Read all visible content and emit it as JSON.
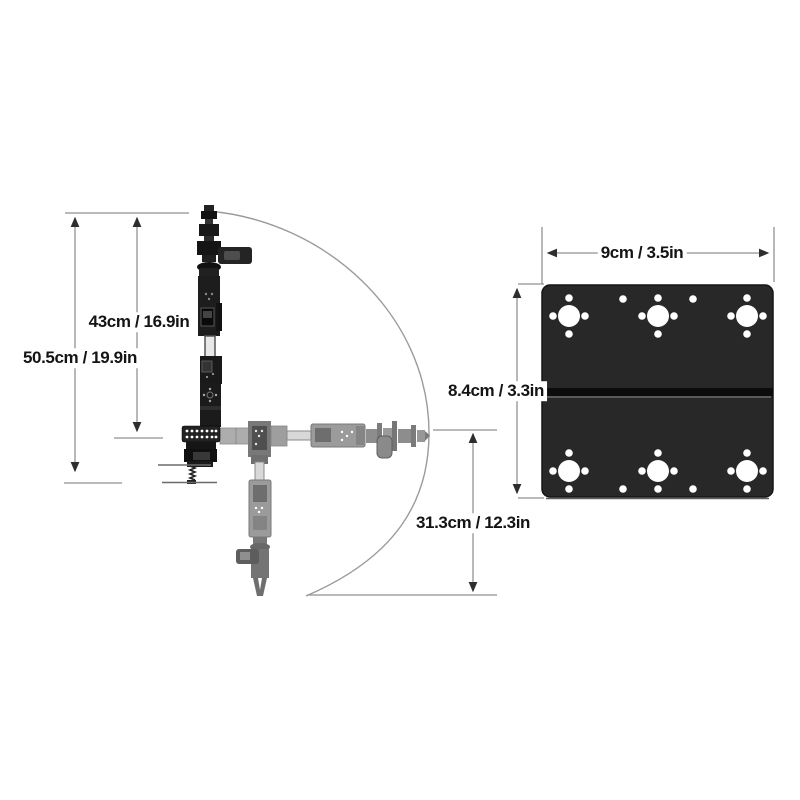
{
  "labels": {
    "overall_height": "50.5cm / 19.9in",
    "upper_height": "43cm / 16.9in",
    "lower_reach": "31.3cm / 12.3in",
    "plate_width": "9cm / 3.5in",
    "plate_height": "8.4cm / 3.3in"
  },
  "colors": {
    "background": "#ffffff",
    "dimension_line": "#919191",
    "arrowhead": "#2e2e2e",
    "label_text": "#141414",
    "arm_dark": "#1b1b1b",
    "arm_ghost": "#9b9b9b",
    "plate": "#282828",
    "plate_groove": "#0c0c0c",
    "hole": "#ffffff"
  }
}
